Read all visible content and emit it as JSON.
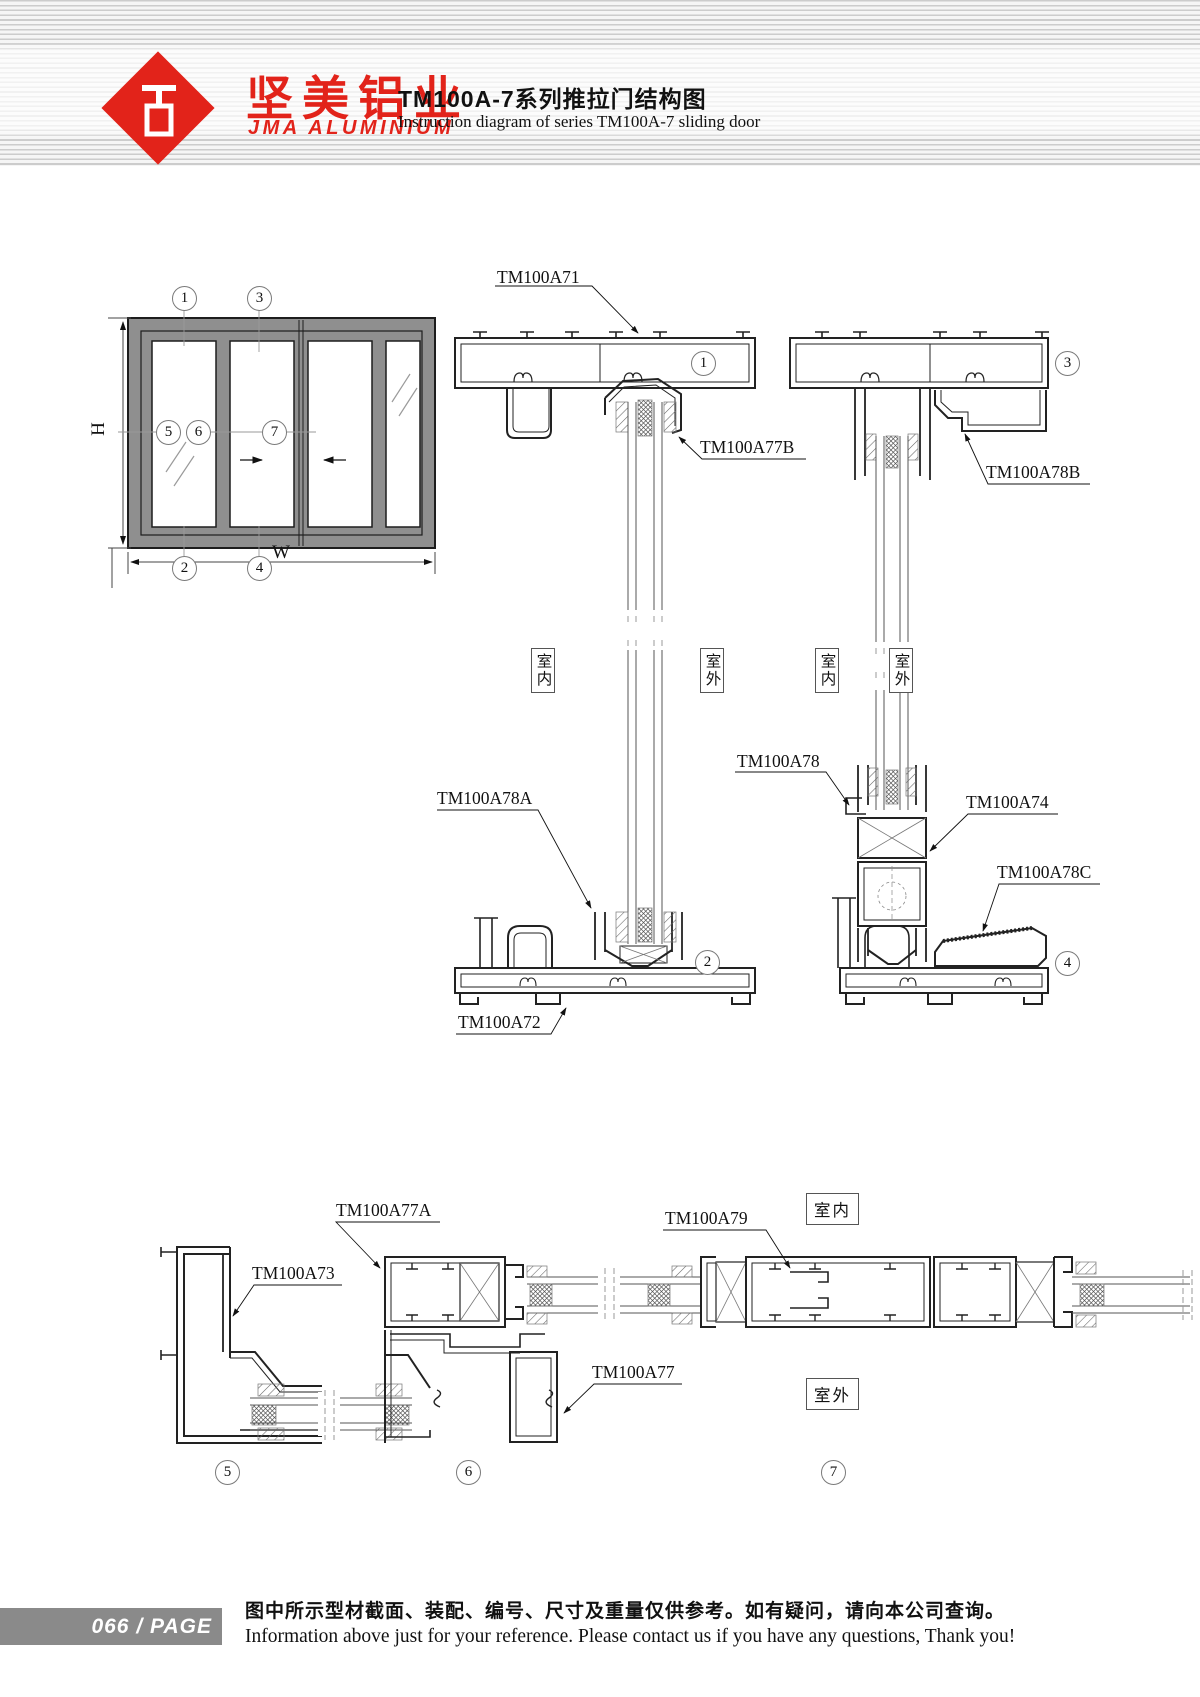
{
  "header": {
    "brand_cn": "坚美铝业",
    "brand_en": "JMA ALUMINIUM",
    "logo_icon": "red-diamond-extrusion-mark",
    "title_cn": "TM100A-7系列推拉门结构图",
    "title_en": "Instruction diagram of series TM100A-7 sliding door"
  },
  "drawing": {
    "dims": {
      "height": "H",
      "width": "W"
    },
    "env": {
      "indoor": "室内",
      "outdoor": "室外"
    },
    "callouts": {
      "n1": "1",
      "n2": "2",
      "n3": "3",
      "n4": "4",
      "n5": "5",
      "n6": "6",
      "n7": "7"
    },
    "parts": {
      "tm100a71": "TM100A71",
      "tm100a72": "TM100A72",
      "tm100a73": "TM100A73",
      "tm100a74": "TM100A74",
      "tm100a77": "TM100A77",
      "tm100a77a": "TM100A77A",
      "tm100a77b": "TM100A77B",
      "tm100a78": "TM100A78",
      "tm100a78a": "TM100A78A",
      "tm100a78b": "TM100A78B",
      "tm100a78c": "TM100A78C",
      "tm100a79": "TM100A79"
    }
  },
  "footer": {
    "page_number": "066",
    "page_sep": "/",
    "page_label": "PAGE",
    "note_cn": "图中所示型材截面、装配、编号、尺寸及重量仅供参考。如有疑问，请向本公司查询。",
    "note_en": "Information above just for your reference. Please contact us if you have any questions, Thank you!"
  },
  "colors": {
    "brand_red": "#e2231a",
    "line": "#222222",
    "frame_gray": "#8f8f8f",
    "stripe_gray": "#cccccc",
    "footer_gray": "#8a8a8a"
  }
}
